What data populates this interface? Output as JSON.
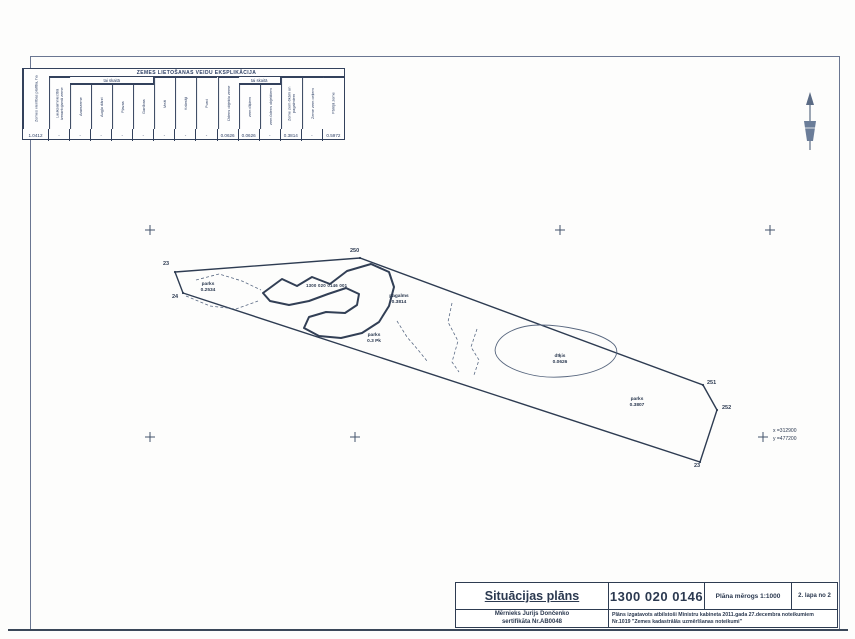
{
  "explication_table": {
    "title": "ZEMES LIETOŠANAS VEIDU EKSPLIKĀCIJA",
    "area_column_label": "Zemes vienības platība, ha",
    "subheader_label_1": "tai skaitā",
    "subheader_label_2": "tai skaitā",
    "columns": [
      "Lauksaimniecībā izmantojamā zeme",
      "Aramzeme",
      "Augļu dārzi",
      "Pļavas",
      "Ganības",
      "Meži",
      "Krūmāji",
      "Purvi",
      "Ūdens objektu zeme",
      "zem dīķiem",
      "zem ūdens objektiem",
      "Zeme zem ēkām un pagalmiem",
      "Zeme zem ceļiem",
      "Pārējā zeme"
    ],
    "values": [
      "1.0412",
      "-",
      "-",
      "-",
      "-",
      "-",
      "-",
      "-",
      "-",
      "0.0626",
      "0.0626",
      "-",
      "0.3814",
      "-",
      "0.5972"
    ]
  },
  "map": {
    "points": [
      {
        "label": "23"
      },
      {
        "label": "24"
      },
      {
        "label": "250"
      },
      {
        "label": "251"
      },
      {
        "label": "252"
      },
      {
        "label": "23"
      }
    ],
    "areas": [
      {
        "line1": "parks",
        "line2": "0.2534"
      },
      {
        "line1": "pagalms",
        "line2": "0.3814"
      },
      {
        "line1": "parks",
        "line2": "0.3 Pk"
      },
      {
        "line1": "dīķis",
        "line2": "0.0626"
      },
      {
        "line1": "parks",
        "line2": "0.3807"
      }
    ],
    "cadastre_label": "1300 020 0146 001",
    "coords": {
      "x_label": "x =312900",
      "y_label": "y =477200"
    }
  },
  "title_block": {
    "title": "Situācijas plāns",
    "cadastre": "1300 020 0146",
    "scale": "Plāna mērogs 1:1000",
    "page": "2. lapa no 2",
    "surveyor": "Mērnieks Jurijs Dončenko",
    "certificate": "sertifikāta Nr.AB0048",
    "regulation_line1": "Plāns izgatavots atbilstoši Ministru kabineta 2011.gada 27.decembra noteikumiem",
    "regulation_line2": "Nr.1019 \"Zemes kadastrālās uzmērīšanas noteikumi\""
  }
}
